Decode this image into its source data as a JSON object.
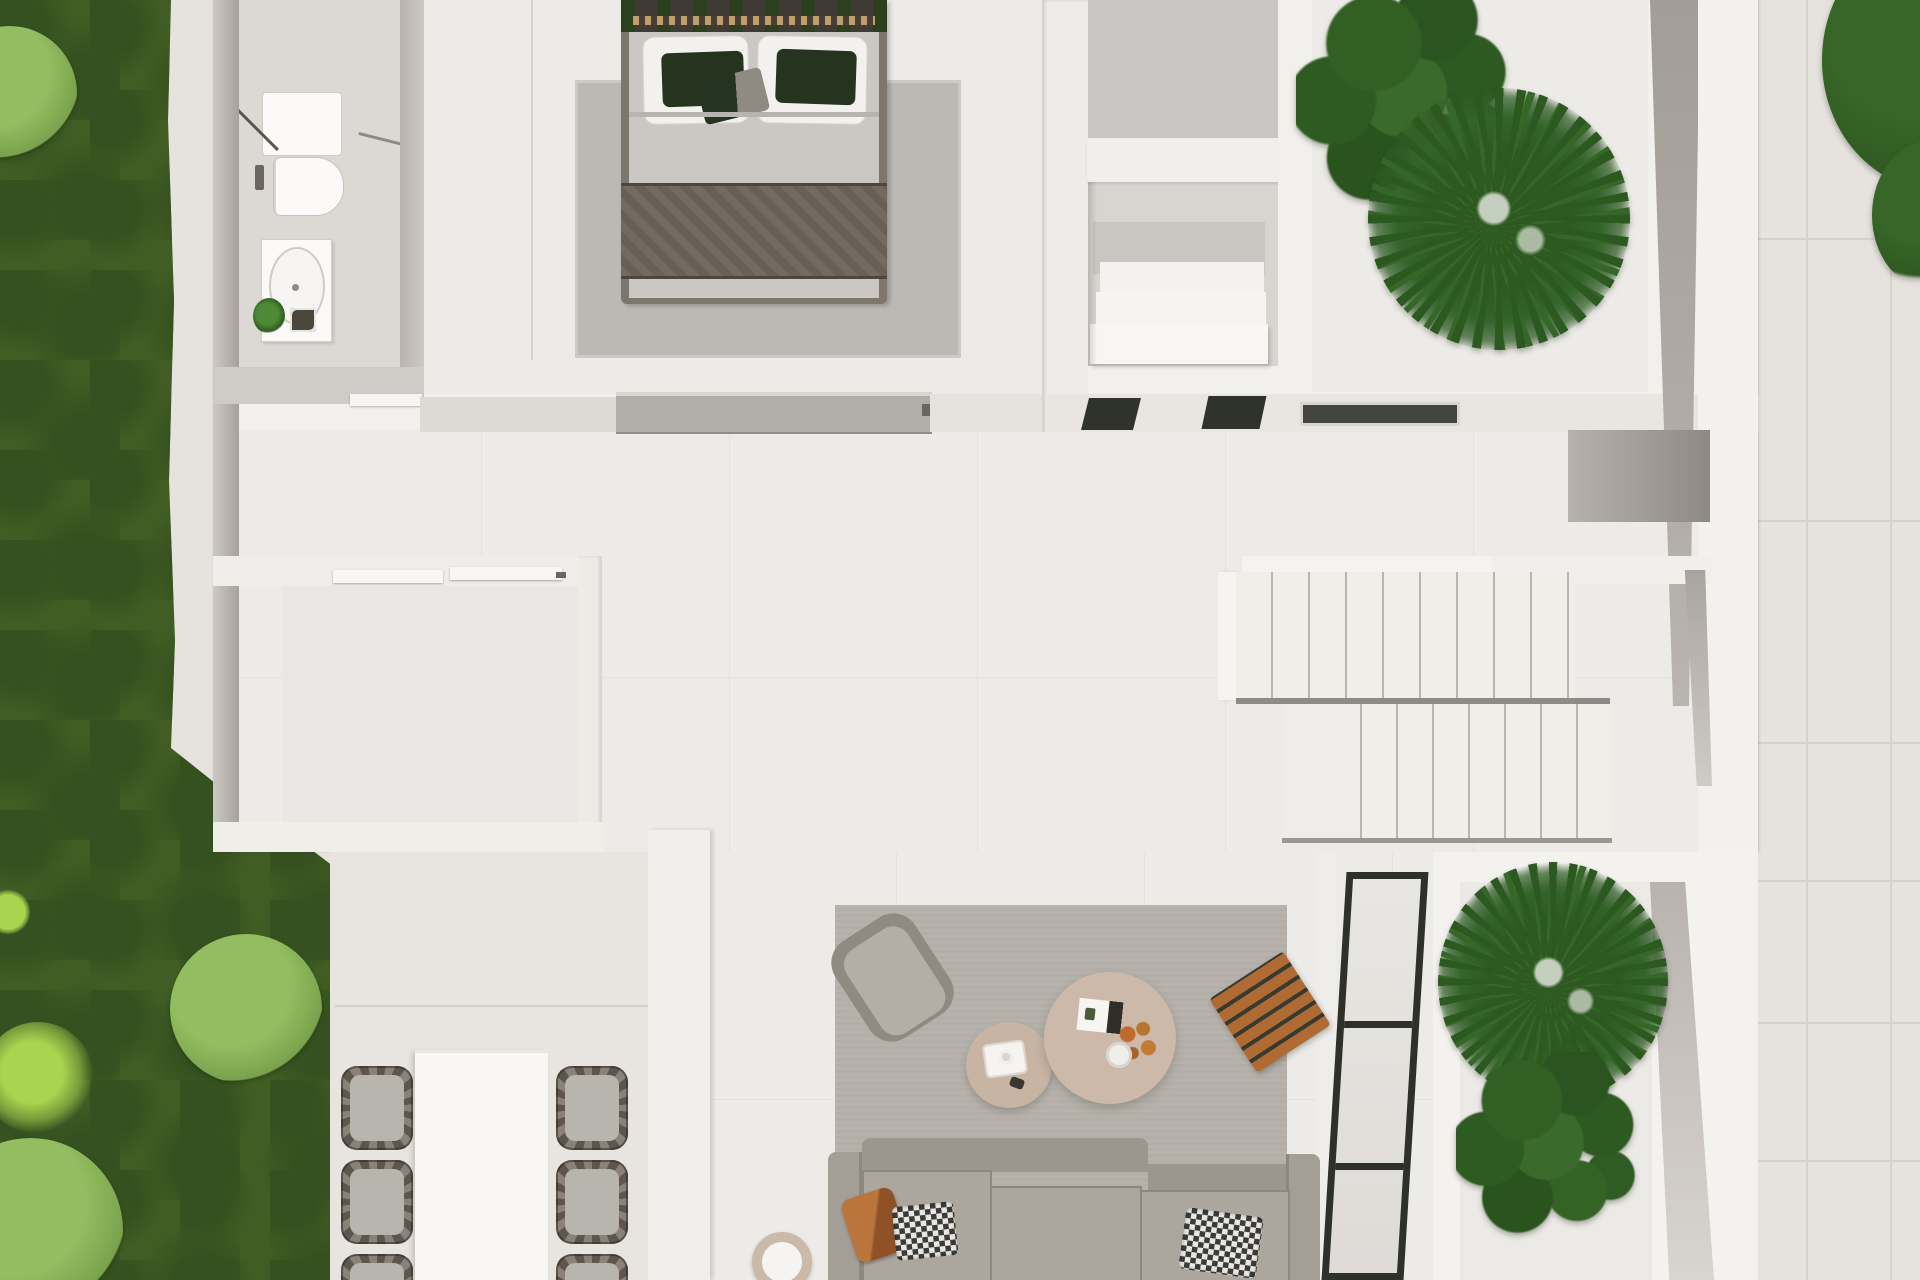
{
  "title": "Top-down 3D architectural floor plan render",
  "palette": {
    "paving": "#e6e2de",
    "paving_line": "#d5d1cd",
    "sidewalk": "#e3dfdb",
    "grass": "#405e24",
    "grass_dark": "#35511f",
    "bush": "#7aa24d",
    "bush_light": "#93bd60",
    "lime": "#a9d44f",
    "tree": "#2f5a22",
    "wall_white": "#f2f0ed",
    "wall_taupe": "#a7a19c",
    "wall_shadow": "#c7c3bf",
    "gray_slider": "#b1ada9",
    "floor": "#edebe7",
    "floor_line": "#dcd8d4",
    "bath_floor": "#dcd8d3",
    "concrete": "#c8c6c2",
    "niche_floor": "#d8d5d1",
    "terrace": "#e8e4e0",
    "rug_bed": "#bcb8b3",
    "rug_living": "#b3afa8",
    "bed_head": "#3f3a33",
    "bed_trim": "#bf9e6b",
    "duvet": "#cbc8c3",
    "runner": "#685f55",
    "pillow_white": "#f2f1ee",
    "pillow_green": "#26331f",
    "sofa": "#a39e96",
    "cushion": "#aca79e",
    "cushion_edge": "#8d887f",
    "pillow_orange": "#b06a34",
    "table_small": "#c8b4a3",
    "table_large": "#ccb9a9",
    "wood": "#b06a34",
    "wood_gap": "#363a2f",
    "chair_seat": "#b8b4ae",
    "dining_table": "#f8f7f5",
    "stair": "#f0eee9",
    "stair_line": "#b8b4b0",
    "glass_dark": "#2f332c",
    "mat_dark": "#42463d",
    "white_fix": "#fbfaf9",
    "frame_black": "#2e312a"
  },
  "scene": {
    "style": "photoreal top-down dollhouse render, no visible text",
    "outdoor": {
      "garden": "lawn strip with shrubs along left edge",
      "patio": "large pale pavers right and bottom-right",
      "tree_canopy": "top-right corner"
    },
    "rooms": [
      {
        "name": "bathroom",
        "position": "top-left",
        "furniture": [
          "walk-in-shower",
          "toilet",
          "vanity-with-basin",
          "small-plant"
        ]
      },
      {
        "name": "bedroom",
        "position": "top-center",
        "furniture": [
          "double-bed",
          "white-pillows x2",
          "dark-green-pillows x2",
          "accent-cushion",
          "textured-runner",
          "area-rug"
        ]
      },
      {
        "name": "walk-in-closet",
        "position": "top-right-of-bedroom",
        "furniture": [
          "linen-shelf-stack"
        ]
      },
      {
        "name": "north-atrium",
        "position": "top-right",
        "furniture": [
          "fiddle-leaf-fig",
          "fan-palm"
        ]
      },
      {
        "name": "hallway",
        "position": "center",
        "furniture": [
          "gray-pocket-door",
          "dark-glass-sliders x2",
          "recessed-door-mat"
        ]
      },
      {
        "name": "storage-room",
        "position": "middle-left",
        "furniture": [
          "sliding-doors"
        ]
      },
      {
        "name": "staircase",
        "position": "center-right",
        "furniture": [
          "upper-flight 9 treads",
          "lower-flight landing + 7 treads"
        ]
      },
      {
        "name": "living-room",
        "position": "bottom-center",
        "furniture": [
          "corner-sofa",
          "armchair",
          "coffee-table-large",
          "coffee-table-small",
          "wood-slat-stool",
          "round-floor-pot",
          "gray-area-rug",
          "black-frame-glazing"
        ]
      },
      {
        "name": "dining-terrace",
        "position": "bottom-left",
        "furniture": [
          "white-dining-table",
          "wicker-chair x6"
        ]
      },
      {
        "name": "south-atrium",
        "position": "bottom-right",
        "furniture": [
          "fan-palm",
          "fiddle-leaf-fig"
        ]
      }
    ]
  }
}
